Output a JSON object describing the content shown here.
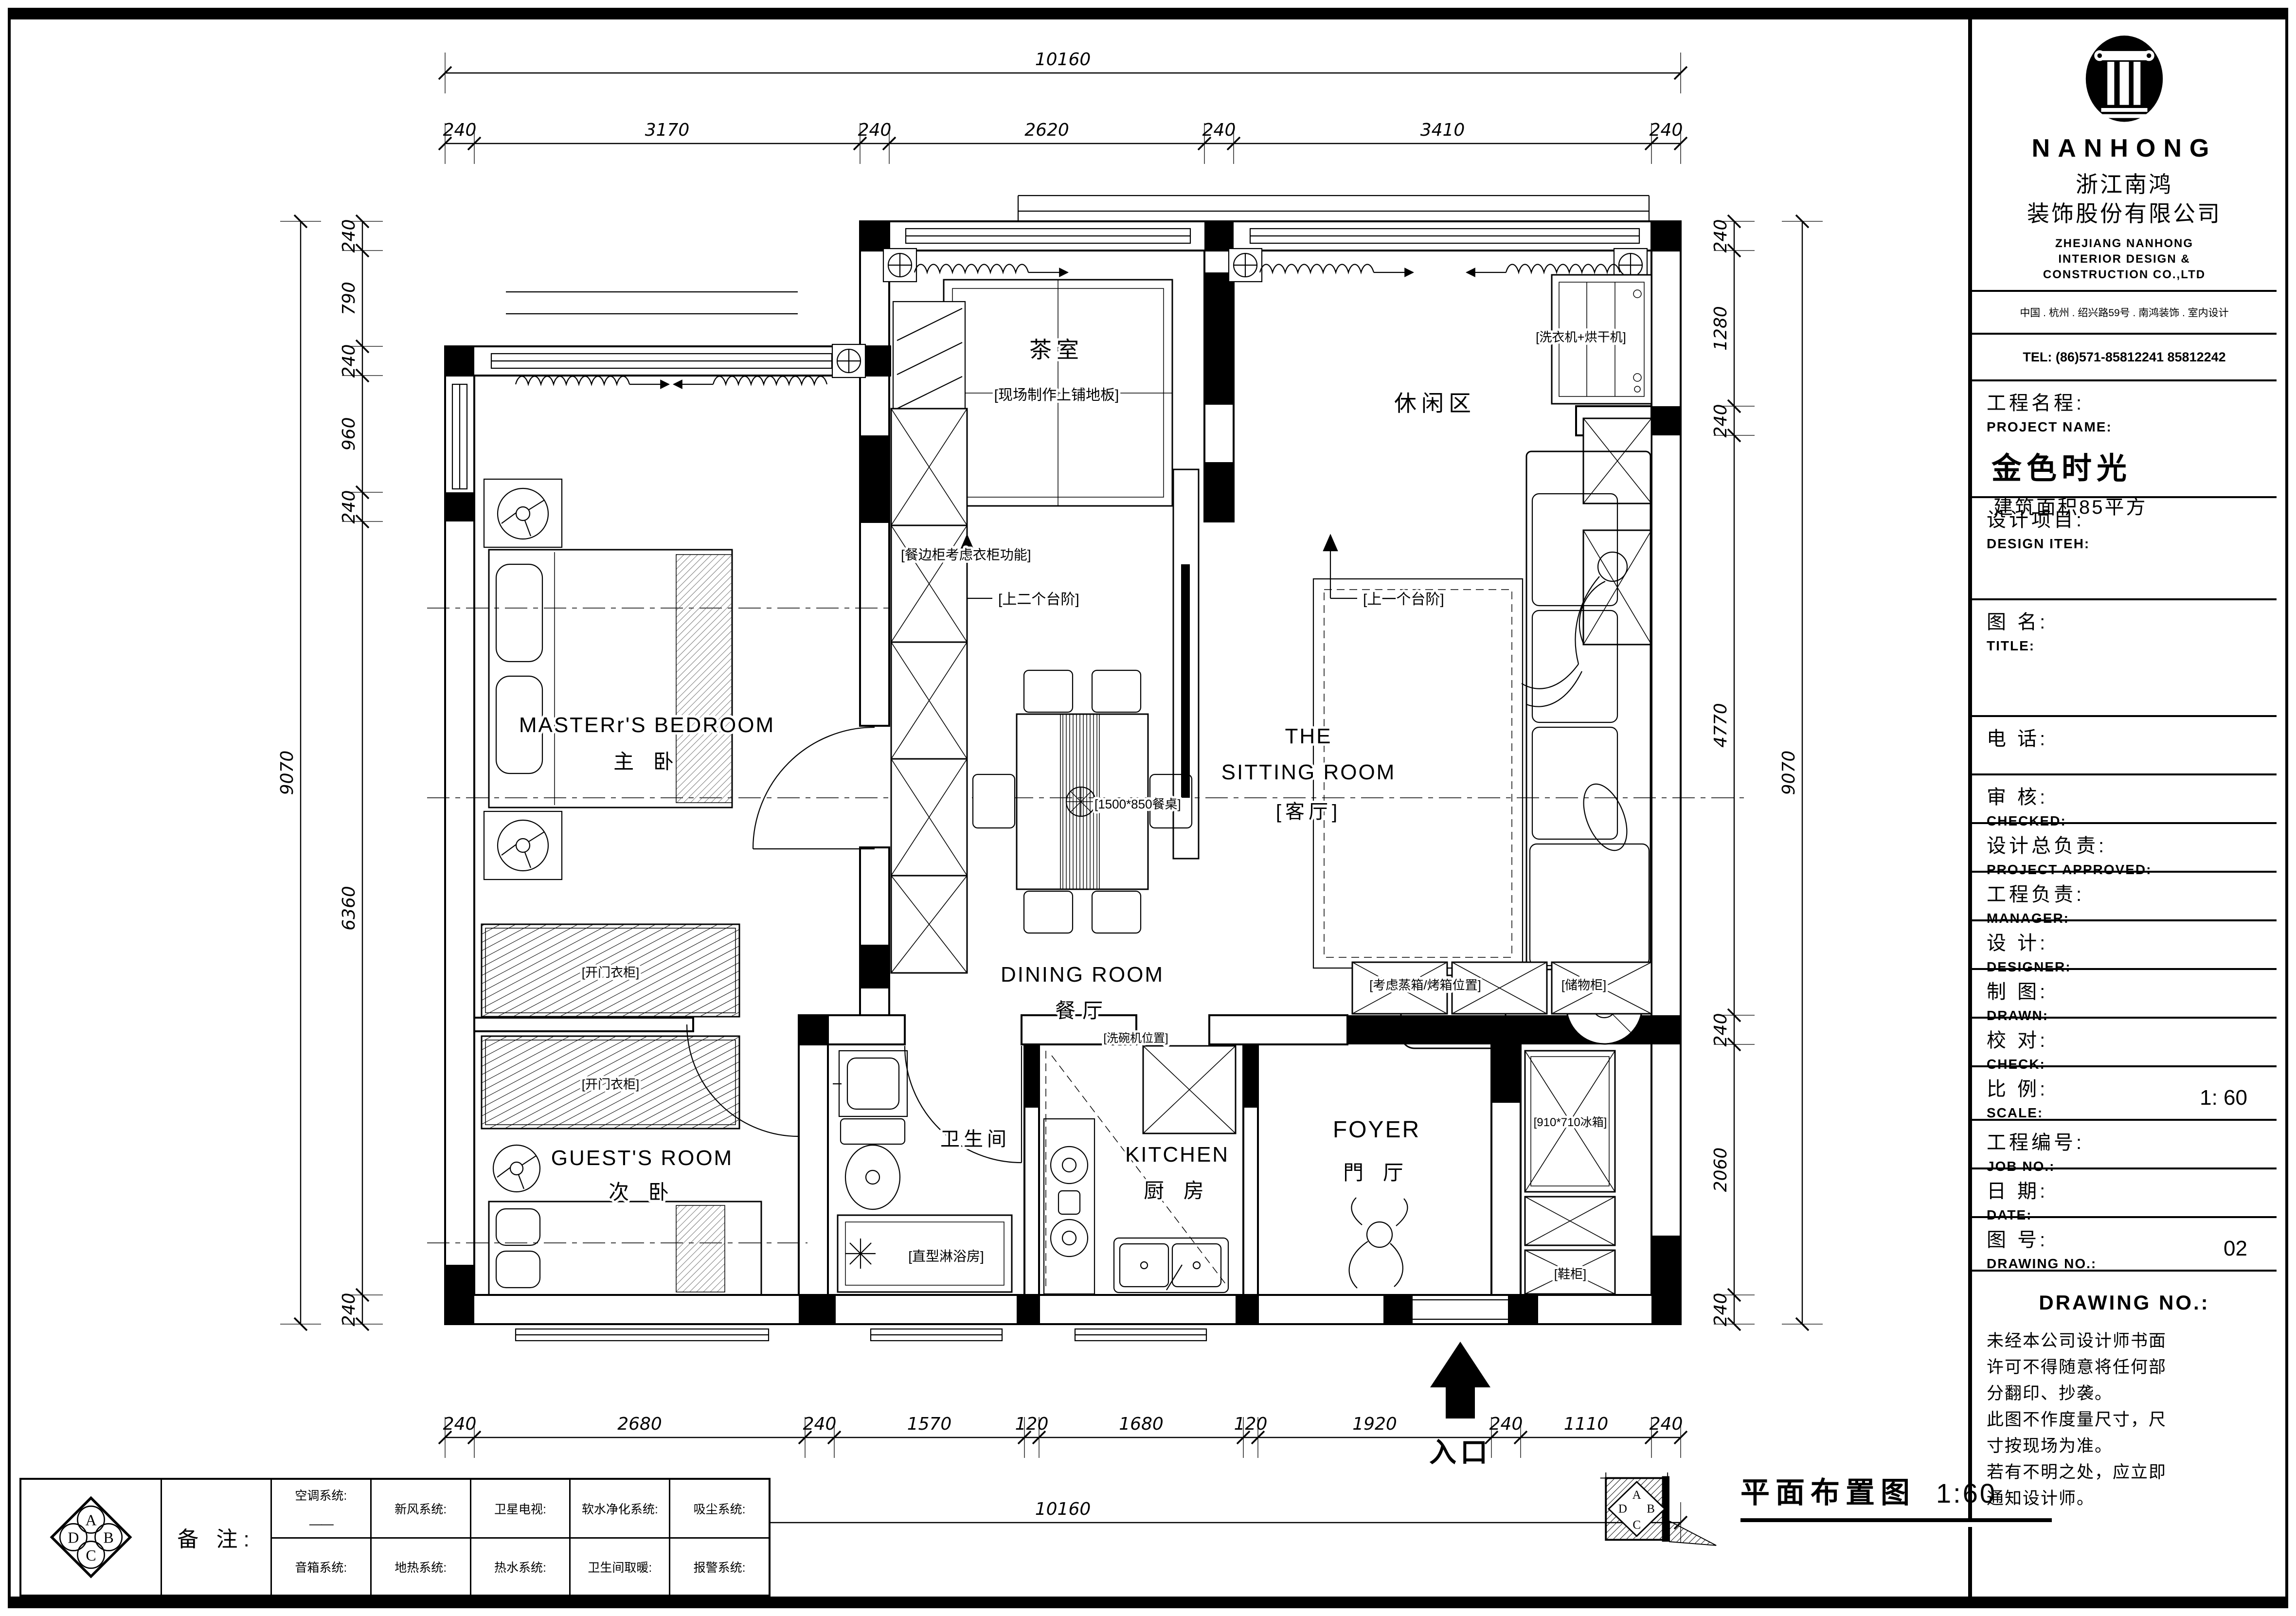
{
  "title_block": {
    "brand": "NANHONG",
    "company_cn_1": "浙江南鸿",
    "company_cn_2": "装饰股份有限公司",
    "company_en_1": "ZHEJIANG NANHONG",
    "company_en_2": "INTERIOR DESIGN &",
    "company_en_3": "CONSTRUCTION CO.,LTD",
    "address": "中国 . 杭州 . 绍兴路59号 .  南鸿装饰 . 室内设计",
    "tel": "TEL: (86)571-85812241  85812242",
    "project_label_cn": "工程名程:",
    "project_label_en": "PROJECT NAME:",
    "project_name": "金色时光",
    "project_area": "建筑面积85平方",
    "rows": [
      {
        "cn": "设计项目:",
        "en": "DESIGN ITEH:",
        "value": ""
      },
      {
        "cn": "图  名:",
        "en": "TITLE:",
        "value": ""
      },
      {
        "cn": "电    话:",
        "en": "",
        "value": ""
      },
      {
        "cn": "审    核:",
        "en": "CHECKED:",
        "value": ""
      },
      {
        "cn": "设计总负责:",
        "en": "PROJECT APPROVED:",
        "value": ""
      },
      {
        "cn": "工程负责:",
        "en": "MANAGER:",
        "value": ""
      },
      {
        "cn": "设    计:",
        "en": "DESIGNER:",
        "value": ""
      },
      {
        "cn": "制    图:",
        "en": "DRAWN:",
        "value": ""
      },
      {
        "cn": "校    对:",
        "en": "CHECK:",
        "value": ""
      },
      {
        "cn": "比    例:",
        "en": "SCALE:",
        "value": "1: 60"
      },
      {
        "cn": "工程编号:",
        "en": "JOB  NO.:",
        "value": ""
      },
      {
        "cn": "日    期:",
        "en": "DATE:",
        "value": ""
      },
      {
        "cn": "图    号:",
        "en": "DRAWING NO.:",
        "value": "02"
      }
    ],
    "drawing_no_heading": "DRAWING NO.:",
    "disclaimer": [
      "未经本公司设计师书面",
      "许可不得随意将任何部",
      "分翻印、抄袭。",
      "此图不作度量尺寸，尺",
      "寸按现场为准。",
      "若有不明之处，应立即",
      "通知设计师。"
    ]
  },
  "notes_table": {
    "remark": "备 注:",
    "compass": [
      "A",
      "B",
      "C",
      "D"
    ],
    "row1": [
      "空调系统:",
      "新风系统:",
      "卫星电视:",
      "软水净化系统:",
      "吸尘系统:"
    ],
    "row1_dash": "——",
    "row2": [
      "音箱系统:",
      "地热系统:",
      "热水系统:",
      "卫生间取暖:",
      "报警系统:"
    ]
  },
  "footer": {
    "title": "平面布置图",
    "scale": "1:60"
  },
  "plan": {
    "tea_room": {
      "name": "茶室",
      "note": "[现场制作上铺地板]"
    },
    "leisure": {
      "name": "休闲区"
    },
    "laundry_note": "[洗衣机+烘干机]",
    "steps_two": "[上二个台阶]",
    "steps_one": "[上一个台阶]",
    "master": {
      "name_en": "MASTERr'S BEDROOM",
      "name_cn": "主  卧"
    },
    "sideboard_note": "[餐边柜考虑衣柜功能]",
    "dining": {
      "name_en": "DINING ROOM",
      "name_cn": "餐厅",
      "table_note": "[1500*850餐桌]"
    },
    "sitting": {
      "line1": "THE",
      "line2": "SITTING ROOM",
      "line3": "[客厅]"
    },
    "wardrobe_note": "[开门衣柜]",
    "guest": {
      "name_en": "GUEST'S ROOM",
      "name_cn": "次 卧"
    },
    "bathroom": {
      "name": "卫生间",
      "shower_note": "[直型淋浴房]"
    },
    "kitchen": {
      "name_en": "KITCHEN",
      "name_cn": "厨 房",
      "dishwasher_note": "[洗碗机位置]"
    },
    "foyer": {
      "name_en": "FOYER",
      "name_cn": "門 厅"
    },
    "cabinet_notes": {
      "oven": "[考虑蒸箱/烤箱位置]",
      "storage": "[储物柜]",
      "fridge": "[910*710冰箱]",
      "shoe": "[鞋柜]"
    },
    "entrance": "入口"
  },
  "dims": {
    "top": [
      "240",
      "3170",
      "240",
      "2620",
      "240",
      "3410",
      "240"
    ],
    "top_total": [
      "10160"
    ],
    "bottom": [
      "240",
      "2680",
      "240",
      "1570",
      "120",
      "1680",
      "120",
      "1920",
      "240",
      "1110",
      "240"
    ],
    "bottom_total": [
      "10160"
    ],
    "left": [
      "240",
      "790",
      "240",
      "960",
      "240",
      "6360",
      "240"
    ],
    "left_total": [
      "9070"
    ],
    "right": [
      "240",
      "1280",
      "240",
      "4770",
      "240",
      "2060",
      "240"
    ],
    "right_total": [
      "9070"
    ]
  }
}
